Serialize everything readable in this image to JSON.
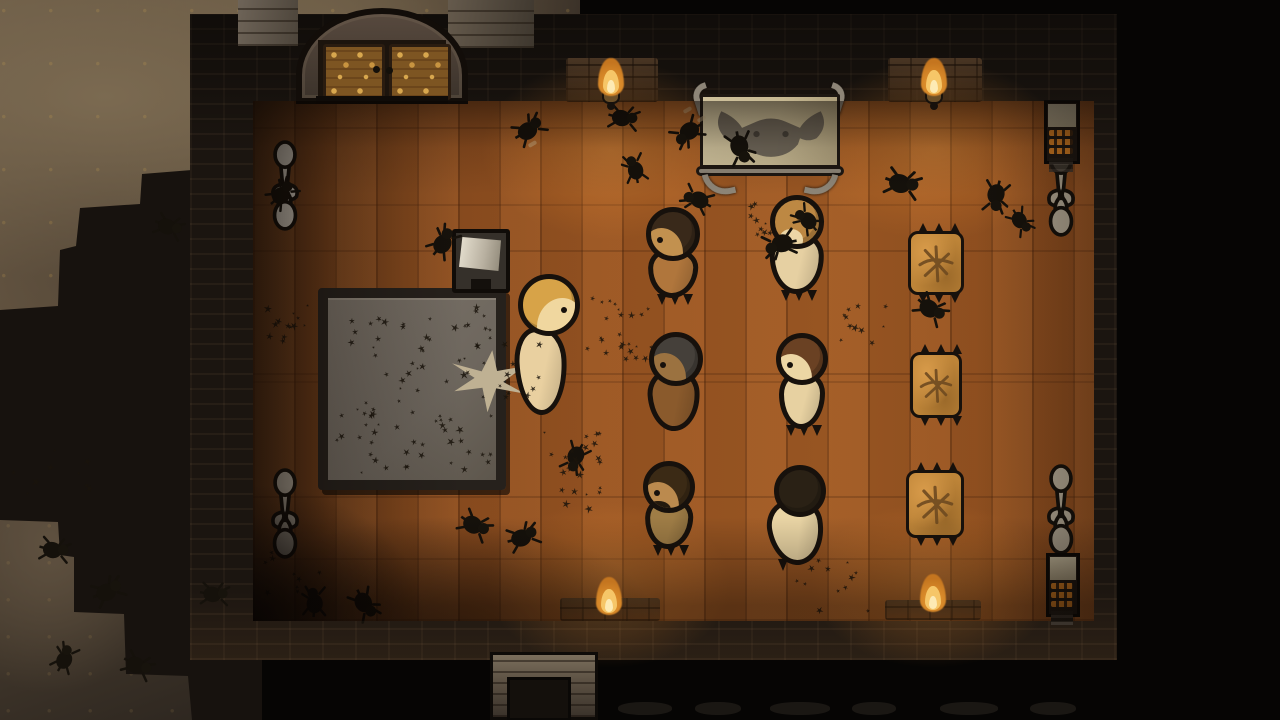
{
  "scene": {
    "description": "top-down colony-sim room at night, torch-lit wooden hall infested with beetles",
    "visible_text": []
  },
  "palette": {
    "outside": "#060504",
    "rock_light": "#7b6a51",
    "rock_dark": "#2e2720",
    "wall": "#1b1510",
    "floor_bright": "#a05a24",
    "floor_dark": "#5e3517",
    "torch_flame": "#f6c668",
    "torch_core": "#fdeab4",
    "gold_door": "#d8a74e",
    "tapestry_cloth": "#c6b892",
    "sculpture_stone": "#c3bcae",
    "bedroll": "#bd8438",
    "slab_top": "#6e675e",
    "outline": "#17110c",
    "skin_pale": "#ecd6a6",
    "skin_tan": "#bb8a4e"
  },
  "room": {
    "wall_x": 190,
    "wall_y": 14,
    "wall_w": 927,
    "wall_h": 646,
    "floor_x": 253,
    "floor_y": 101,
    "floor_w": 841,
    "floor_h": 520
  },
  "rocks": {
    "upper": {
      "x": 0,
      "y": 0,
      "w": 580,
      "h": 320
    },
    "lower": {
      "x": 0,
      "y": 400,
      "w": 200,
      "h": 320
    }
  },
  "door": {
    "x": 296,
    "y": 8,
    "w": 172,
    "h": 96,
    "panel_color": "#7d5522",
    "knob_color": "#14100a",
    "grey_patch_left": {
      "x": 238,
      "y": 0,
      "w": 60,
      "h": 46
    },
    "grey_patch_right": {
      "x": 448,
      "y": 0,
      "w": 86,
      "h": 48
    }
  },
  "torches": [
    {
      "cx": 611,
      "base_y": 100,
      "bracket": true
    },
    {
      "cx": 934,
      "base_y": 100,
      "bracket": true
    },
    {
      "cx": 609,
      "base_y": 619,
      "bracket": false
    },
    {
      "cx": 933,
      "base_y": 616,
      "bracket": false
    }
  ],
  "lit_patches": [
    {
      "x": 566,
      "y": 58,
      "w": 92,
      "h": 44
    },
    {
      "x": 888,
      "y": 58,
      "w": 94,
      "h": 44
    },
    {
      "x": 560,
      "y": 598,
      "w": 100,
      "h": 23
    },
    {
      "x": 885,
      "y": 600,
      "w": 96,
      "h": 20
    }
  ],
  "floor_glows": [
    {
      "cx": 611,
      "cy": 150,
      "w": 360,
      "h": 250
    },
    {
      "cx": 934,
      "cy": 150,
      "w": 360,
      "h": 250
    },
    {
      "cx": 609,
      "cy": 585,
      "w": 340,
      "h": 230
    },
    {
      "cx": 933,
      "cy": 585,
      "w": 340,
      "h": 230
    }
  ],
  "tapestry": {
    "x": 694,
    "y": 84,
    "w": 152,
    "h": 100,
    "cloth": "#c6b892",
    "frame": "#8d8577",
    "face": "#565048"
  },
  "sculptures": [
    {
      "x": 266,
      "y": 140,
      "color": "#d3ccbf"
    },
    {
      "x": 266,
      "y": 468,
      "color": "#b6ad9e"
    },
    {
      "x": 1042,
      "y": 146,
      "color": "#aba18e"
    },
    {
      "x": 1042,
      "y": 464,
      "color": "#aba18e"
    }
  ],
  "shelves": [
    {
      "x": 1044,
      "y": 100,
      "w": 36,
      "h": 64
    },
    {
      "x": 1046,
      "y": 553,
      "w": 34,
      "h": 64
    }
  ],
  "slab": {
    "x": 318,
    "y": 288,
    "w": 188,
    "h": 202,
    "border": "#26211c",
    "top": "#6e675e"
  },
  "splat": {
    "x": 450,
    "y": 350,
    "w": 76,
    "h": 62,
    "color": "#bfb193",
    "rot": 8
  },
  "lectern": {
    "x": 452,
    "y": 229,
    "w": 58,
    "h": 64
  },
  "bedrolls": [
    {
      "x": 908,
      "y": 231,
      "w": 56,
      "h": 64
    },
    {
      "x": 910,
      "y": 352,
      "w": 52,
      "h": 66
    },
    {
      "x": 906,
      "y": 470,
      "w": 58,
      "h": 68
    }
  ],
  "chimney": {
    "x": 490,
    "y": 652,
    "w": 108,
    "h": 68
  },
  "bottom_rubble": [
    {
      "x": 618,
      "w": 54
    },
    {
      "x": 695,
      "w": 46
    },
    {
      "x": 770,
      "w": 60
    },
    {
      "x": 852,
      "w": 44
    },
    {
      "x": 940,
      "w": 58
    },
    {
      "x": 1030,
      "w": 46
    }
  ],
  "debris": [
    {
      "x": 683,
      "y": 108
    },
    {
      "x": 697,
      "y": 117
    },
    {
      "x": 528,
      "y": 142
    }
  ],
  "pawns": [
    {
      "hx": 549,
      "hy": 305,
      "r": 31,
      "hair": "#d7a348",
      "skin": "#f0d79f",
      "body": "#e9d0a0",
      "facing": "right",
      "bw": 52,
      "bh": 88,
      "bdx": -8,
      "bdy": 22,
      "rot": -3,
      "feet": false,
      "beard": false
    },
    {
      "hx": 673,
      "hy": 234,
      "r": 27,
      "hair": "#39291a",
      "skin": "#c2914f",
      "body": "#b0763c",
      "facing": "left",
      "bw": 50,
      "bh": 50,
      "bdx": 0,
      "bdy": 14,
      "rot": 2,
      "feet": true,
      "beard": false
    },
    {
      "hx": 797,
      "hy": 222,
      "r": 27,
      "hair": "#bd8843",
      "skin": "#ecd6a6",
      "body": "#e6d0a2",
      "facing": "back",
      "bw": 54,
      "bh": 62,
      "bdx": 0,
      "bdy": 10,
      "rot": -2,
      "feet": true,
      "beard": false,
      "sliver": true
    },
    {
      "hx": 676,
      "hy": 359,
      "r": 27,
      "hair": "#45403a",
      "skin": "#9b7240",
      "body": "#8a5a2c",
      "facing": "left",
      "bw": 52,
      "bh": 62,
      "bdx": -2,
      "bdy": 10,
      "rot": -4,
      "feet": false,
      "beard": false
    },
    {
      "hx": 802,
      "hy": 359,
      "r": 26,
      "hair": "#6a4123",
      "skin": "#ecd6a4",
      "body": "#e7d1a1",
      "facing": "left",
      "bw": 46,
      "bh": 58,
      "bdx": 0,
      "bdy": 12,
      "rot": 0,
      "feet": true,
      "beard": false
    },
    {
      "hx": 669,
      "hy": 487,
      "r": 26,
      "hair": "#3b2a15",
      "skin": "#bb8a4e",
      "body": "#9f7d46",
      "facing": "left",
      "bw": 48,
      "bh": 52,
      "bdx": 0,
      "bdy": 10,
      "rot": 2,
      "feet": true,
      "beard": true
    },
    {
      "hx": 800,
      "hy": 491,
      "r": 26,
      "hair": "#2a2115",
      "skin": "#ecd6a6",
      "body": "#ead5a5",
      "facing": "back",
      "bw": 56,
      "bh": 66,
      "bdx": -4,
      "bdy": 8,
      "rot": -10,
      "feet": false,
      "beard": false,
      "onespike": true
    }
  ],
  "beetles": [
    {
      "x": 513,
      "y": 114,
      "rot": -30,
      "s": 1
    },
    {
      "x": 607,
      "y": 104,
      "rot": 15,
      "s": 0.95
    },
    {
      "x": 668,
      "y": 118,
      "rot": 150,
      "s": 1
    },
    {
      "x": 722,
      "y": 135,
      "rot": 80,
      "s": 1.05
    },
    {
      "x": 617,
      "y": 152,
      "rot": -100,
      "s": 0.9
    },
    {
      "x": 678,
      "y": 183,
      "rot": -150,
      "s": 0.95
    },
    {
      "x": 886,
      "y": 170,
      "rot": 20,
      "s": 1.1
    },
    {
      "x": 977,
      "y": 183,
      "rot": 105,
      "s": 1
    },
    {
      "x": 1003,
      "y": 208,
      "rot": 60,
      "s": 0.85
    },
    {
      "x": 914,
      "y": 296,
      "rot": 40,
      "s": 1
    },
    {
      "x": 266,
      "y": 178,
      "rot": -40,
      "s": 0.95
    },
    {
      "x": 152,
      "y": 213,
      "rot": 25,
      "s": 0.9
    },
    {
      "x": 427,
      "y": 226,
      "rot": -50,
      "s": 1
    },
    {
      "x": 788,
      "y": 203,
      "rot": -130,
      "s": 0.9
    },
    {
      "x": 760,
      "y": 229,
      "rot": 170,
      "s": 1.05
    },
    {
      "x": 556,
      "y": 444,
      "rot": 120,
      "s": 0.95
    },
    {
      "x": 458,
      "y": 512,
      "rot": 35,
      "s": 1
    },
    {
      "x": 507,
      "y": 522,
      "rot": -15,
      "s": 1
    },
    {
      "x": 347,
      "y": 591,
      "rot": 65,
      "s": 1
    },
    {
      "x": 297,
      "y": 585,
      "rot": -85,
      "s": 0.95
    },
    {
      "x": 198,
      "y": 580,
      "rot": 10,
      "s": 0.9
    },
    {
      "x": 38,
      "y": 536,
      "rot": 15,
      "s": 0.95
    },
    {
      "x": 92,
      "y": 576,
      "rot": -20,
      "s": 1
    },
    {
      "x": 121,
      "y": 652,
      "rot": 30,
      "s": 0.95
    },
    {
      "x": 48,
      "y": 642,
      "rot": -60,
      "s": 0.9
    }
  ],
  "swarms": [
    {
      "x": 334,
      "y": 304,
      "w": 158,
      "h": 168,
      "n": 85,
      "seed": 7
    },
    {
      "x": 498,
      "y": 330,
      "w": 38,
      "h": 66,
      "n": 10,
      "seed": 11
    },
    {
      "x": 584,
      "y": 296,
      "w": 66,
      "h": 62,
      "n": 24,
      "seed": 3
    },
    {
      "x": 540,
      "y": 430,
      "w": 60,
      "h": 76,
      "n": 24,
      "seed": 5
    },
    {
      "x": 258,
      "y": 300,
      "w": 50,
      "h": 40,
      "n": 13,
      "seed": 9
    },
    {
      "x": 262,
      "y": 548,
      "w": 56,
      "h": 58,
      "n": 11,
      "seed": 13
    },
    {
      "x": 735,
      "y": 196,
      "w": 40,
      "h": 38,
      "n": 9,
      "seed": 17
    },
    {
      "x": 838,
      "y": 300,
      "w": 46,
      "h": 40,
      "n": 11,
      "seed": 19
    },
    {
      "x": 788,
      "y": 556,
      "w": 90,
      "h": 56,
      "n": 12,
      "seed": 23
    },
    {
      "x": 8,
      "y": 448,
      "w": 78,
      "h": 48,
      "n": 9,
      "seed": 29
    }
  ]
}
